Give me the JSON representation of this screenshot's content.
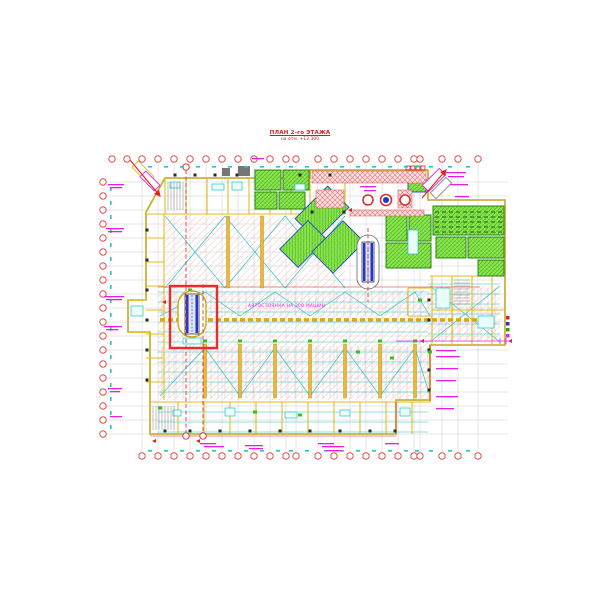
{
  "title": {
    "line1": "ПЛАН 2-го ЭТАЖА",
    "line2": "на отм. +12.300"
  },
  "labels": {
    "parking": "АВТОСТОЯНКА НА 300 МАШИН"
  },
  "colors": {
    "axis_red": "#e05050",
    "red": "#e02020",
    "wall_yellow": "#e2bb22",
    "wall_dark": "#a98a00",
    "strip_yellow": "#efb63a",
    "green_fill": "#8ae24e",
    "green_dark": "#2f9e12",
    "blue": "#2336c8",
    "cyan": "#27c3c3",
    "magenta": "#e81ee8",
    "grid_gray": "#c2c2c2",
    "pink": "#efb3b3",
    "dark": "#2a2a2a"
  },
  "drawing": {
    "grid": {
      "xs": [
        142,
        158,
        174,
        190,
        206,
        222,
        238,
        254,
        270,
        286,
        296,
        318,
        334,
        350,
        366,
        382,
        398,
        414,
        420,
        442,
        458,
        478
      ],
      "top_extra": [
        112,
        127
      ],
      "ys": [
        182,
        196,
        210,
        224,
        238,
        252,
        266,
        280,
        294,
        308,
        322,
        336,
        350,
        364,
        378,
        392,
        406,
        420,
        434
      ],
      "x1": 106,
      "x2": 508,
      "y1": 163,
      "y2": 452,
      "top_y": 159,
      "bottom_y": 456,
      "left_x": 103,
      "tick_top_y": 166,
      "tick_bottom_y": 450,
      "tick_left_x": 110
    },
    "outline": "165,178 310,178 310,170 428,170 428,200 505,200 505,345 430,345 430,400 396,400 396,434 150,434 150,332 128,332 128,300 146,300 146,212",
    "zones": [
      {
        "x": 165,
        "y": 216,
        "w": 180,
        "h": 72
      },
      {
        "x": 158,
        "y": 290,
        "w": 272,
        "h": 110
      },
      {
        "x": 430,
        "y": 286,
        "w": 70,
        "h": 56
      }
    ],
    "stall_bands": [
      {
        "x1": 162,
        "x2": 428,
        "y": 292,
        "h": 24,
        "step": 7
      },
      {
        "x1": 162,
        "x2": 428,
        "y": 346,
        "h": 52,
        "step": 7
      },
      {
        "x1": 432,
        "x2": 498,
        "y": 288,
        "h": 52,
        "step": 7
      }
    ],
    "cyan_bands": [
      {
        "x1": 158,
        "x2": 428,
        "y1": 292,
        "y2": 432,
        "step": 10
      },
      {
        "x1": 428,
        "x2": 500,
        "y1": 284,
        "y2": 342,
        "step": 10
      }
    ],
    "cyan_zigzags": [
      "165,288 225,216 285,288 345,216",
      "165,216 225,288 285,216 345,288",
      "160,316 205,292 240,316 275,292 310,316 345,292 380,316 415,292 430,316",
      "160,396 205,348 240,396 275,348 310,396 345,348 380,396 415,348 430,396",
      "430,342 500,286",
      "430,286 500,342"
    ],
    "walls": [
      [
        146,
        214,
        345,
        214
      ],
      [
        165,
        178,
        165,
        214
      ],
      [
        186,
        178,
        186,
        214
      ],
      [
        207,
        178,
        207,
        214
      ],
      [
        228,
        178,
        228,
        214
      ],
      [
        249,
        178,
        249,
        214
      ],
      [
        270,
        178,
        270,
        214
      ],
      [
        291,
        178,
        291,
        214
      ],
      [
        310,
        178,
        310,
        214
      ],
      [
        345,
        178,
        345,
        214
      ],
      [
        164,
        214,
        164,
        400
      ],
      [
        146,
        238,
        164,
        238
      ],
      [
        146,
        262,
        164,
        262
      ],
      [
        146,
        286,
        164,
        286
      ],
      [
        146,
        310,
        164,
        310
      ],
      [
        146,
        334,
        164,
        334
      ],
      [
        146,
        358,
        164,
        358
      ],
      [
        146,
        382,
        164,
        382
      ],
      [
        150,
        402,
        430,
        402
      ],
      [
        178,
        402,
        178,
        434
      ],
      [
        204,
        402,
        204,
        434
      ],
      [
        230,
        402,
        230,
        434
      ],
      [
        256,
        402,
        256,
        434
      ],
      [
        282,
        402,
        282,
        434
      ],
      [
        308,
        402,
        308,
        434
      ],
      [
        334,
        402,
        334,
        434
      ],
      [
        360,
        402,
        360,
        434
      ],
      [
        386,
        402,
        386,
        434
      ],
      [
        412,
        402,
        412,
        434
      ],
      [
        430,
        276,
        505,
        276
      ],
      [
        432,
        276,
        432,
        344
      ],
      [
        452,
        276,
        452,
        344
      ],
      [
        472,
        276,
        472,
        344
      ],
      [
        492,
        276,
        492,
        344
      ],
      [
        432,
        310,
        505,
        310
      ],
      [
        408,
        288,
        432,
        288
      ],
      [
        408,
        288,
        408,
        316
      ],
      [
        408,
        316,
        432,
        316
      ],
      [
        128,
        300,
        146,
        300
      ],
      [
        128,
        332,
        150,
        332
      ]
    ],
    "red_lines": [
      [
        158,
        287,
        480,
        287
      ],
      [
        430,
        345,
        430,
        402
      ],
      [
        396,
        402,
        396,
        434
      ],
      [
        150,
        436,
        396,
        436
      ]
    ],
    "yellow_strips": {
      "lower": {
        "xs": [
          205,
          240,
          275,
          310,
          345,
          380,
          415
        ],
        "y1": 344,
        "y2": 398
      },
      "upper": {
        "xs": [
          228,
          262
        ],
        "y1": 216,
        "y2": 288
      }
    },
    "dashed_band": {
      "x1": 160,
      "x2": 478,
      "y": 320
    },
    "green_rooms": [
      {
        "x": 255,
        "y": 170,
        "w": 26,
        "h": 20
      },
      {
        "x": 283,
        "y": 170,
        "w": 26,
        "h": 20
      },
      {
        "x": 255,
        "y": 192,
        "w": 22,
        "h": 17
      },
      {
        "x": 279,
        "y": 192,
        "w": 26,
        "h": 17
      },
      {
        "x": 386,
        "y": 215,
        "w": 21,
        "h": 26
      },
      {
        "x": 409,
        "y": 215,
        "w": 22,
        "h": 26
      },
      {
        "x": 386,
        "y": 243,
        "w": 45,
        "h": 25
      },
      {
        "x": 433,
        "y": 206,
        "w": 71,
        "h": 29,
        "desk": true
      },
      {
        "x": 436,
        "y": 237,
        "w": 30,
        "h": 21
      },
      {
        "x": 468,
        "y": 237,
        "w": 36,
        "h": 21
      },
      {
        "x": 478,
        "y": 260,
        "w": 26,
        "h": 16
      },
      {
        "x": 408,
        "y": 178,
        "w": 18,
        "h": 14,
        "blue": true
      }
    ],
    "green_diag": [
      {
        "cx": 322,
        "cy": 213,
        "w": 46,
        "h": 30,
        "r": -45
      },
      {
        "cx": 303,
        "cy": 244,
        "w": 40,
        "h": 26,
        "r": -45
      },
      {
        "cx": 338,
        "cy": 247,
        "w": 44,
        "h": 30,
        "r": -45
      }
    ],
    "red_hatch": [
      {
        "x": 312,
        "y": 171,
        "w": 114,
        "h": 12
      },
      {
        "x": 316,
        "y": 190,
        "w": 28,
        "h": 18
      },
      {
        "x": 398,
        "y": 190,
        "w": 14,
        "h": 18
      },
      {
        "x": 350,
        "y": 210,
        "w": 74,
        "h": 6
      }
    ],
    "red_squares": [
      [
        406,
        166
      ],
      [
        411,
        166
      ],
      [
        416,
        166
      ],
      [
        421,
        166
      ]
    ],
    "circles": {
      "y": 200,
      "items": [
        {
          "x": 368,
          "r": 5
        },
        {
          "x": 386,
          "r": 5.5,
          "blue": true
        },
        {
          "x": 405,
          "r": 5
        }
      ]
    },
    "escalators": [
      {
        "cx": 192,
        "top": 294,
        "w": 14,
        "h": 40,
        "rx": 14,
        "ry": 23,
        "oy": 314,
        "main": true
      },
      {
        "cx": 368,
        "top": 242,
        "w": 12,
        "h": 40,
        "rx": 11,
        "ry": 27,
        "oy": 262
      }
    ],
    "highlight_box": {
      "x": 170,
      "y": 286,
      "w": 47,
      "h": 62
    },
    "red_dashed": [
      {
        "x": 186,
        "y1": 170,
        "y2": 432,
        "b1": 167,
        "b2": 436
      },
      {
        "x": 203,
        "y1": 284,
        "y2": 432,
        "b2": 436
      },
      {
        "x": 368,
        "y1": 228,
        "y2": 302
      }
    ],
    "cyan_rects": [
      [
        170,
        182,
        10,
        6
      ],
      [
        212,
        184,
        12,
        6
      ],
      [
        232,
        182,
        10,
        8
      ],
      [
        295,
        184,
        10,
        6
      ],
      [
        173,
        410,
        8,
        6
      ],
      [
        225,
        408,
        10,
        8
      ],
      [
        285,
        412,
        12,
        6
      ],
      [
        340,
        410,
        10,
        6
      ],
      [
        400,
        408,
        10,
        8
      ],
      [
        436,
        288,
        14,
        20
      ],
      [
        478,
        316,
        16,
        12
      ],
      [
        183,
        338,
        18,
        6
      ],
      [
        408,
        230,
        10,
        24
      ],
      [
        131,
        306,
        12,
        10
      ]
    ],
    "dark_rects": [
      [
        222,
        168,
        8,
        8
      ],
      [
        238,
        166,
        12,
        10
      ]
    ],
    "marks_dark": [
      [
        175,
        175
      ],
      [
        195,
        175
      ],
      [
        215,
        175
      ],
      [
        237,
        175
      ],
      [
        300,
        175
      ],
      [
        330,
        175
      ],
      [
        165,
        431
      ],
      [
        190,
        431
      ],
      [
        220,
        431
      ],
      [
        250,
        431
      ],
      [
        280,
        431
      ],
      [
        310,
        431
      ],
      [
        340,
        431
      ],
      [
        370,
        431
      ],
      [
        395,
        431
      ],
      [
        147,
        230
      ],
      [
        147,
        260
      ],
      [
        147,
        290
      ],
      [
        147,
        320
      ],
      [
        147,
        350
      ],
      [
        147,
        380
      ],
      [
        429,
        300
      ],
      [
        429,
        320
      ],
      [
        429,
        350
      ],
      [
        429,
        370
      ],
      [
        429,
        390
      ],
      [
        344,
        212
      ],
      [
        312,
        212
      ]
    ],
    "marks_green": [
      [
        160,
        408
      ],
      [
        358,
        352
      ],
      [
        392,
        358
      ],
      [
        300,
        415
      ],
      [
        255,
        412
      ],
      [
        420,
        300
      ],
      [
        430,
        352
      ],
      [
        190,
        290
      ],
      [
        205,
        341
      ],
      [
        240,
        341
      ],
      [
        275,
        341
      ],
      [
        310,
        341
      ],
      [
        345,
        341
      ],
      [
        380,
        341
      ],
      [
        415,
        341
      ]
    ],
    "marks_red": [
      [
        196,
        441
      ],
      [
        152,
        441
      ],
      [
        162,
        302
      ],
      [
        348,
        210
      ],
      [
        420,
        341
      ],
      [
        508,
        341
      ]
    ],
    "magenta_bars": [
      [
        108,
        184,
        16
      ],
      [
        110,
        187,
        12
      ],
      [
        106,
        228,
        18
      ],
      [
        108,
        231,
        14
      ],
      [
        104,
        296,
        20
      ],
      [
        106,
        299,
        16
      ],
      [
        104,
        326,
        18
      ],
      [
        106,
        329,
        12
      ],
      [
        108,
        388,
        14
      ],
      [
        110,
        391,
        10
      ],
      [
        110,
        416,
        12
      ],
      [
        200,
        443,
        16
      ],
      [
        204,
        446,
        20
      ],
      [
        245,
        445,
        18
      ],
      [
        249,
        448,
        14
      ],
      [
        318,
        443,
        16
      ],
      [
        322,
        446,
        22
      ],
      [
        326,
        450,
        16
      ],
      [
        385,
        443,
        14
      ],
      [
        436,
        350,
        20
      ],
      [
        436,
        356,
        24
      ],
      [
        436,
        368,
        22
      ],
      [
        436,
        380,
        20
      ],
      [
        436,
        396,
        22
      ],
      [
        436,
        408,
        18
      ],
      [
        446,
        172,
        20
      ],
      [
        448,
        176,
        16
      ],
      [
        450,
        184,
        18
      ],
      [
        455,
        196,
        14
      ],
      [
        252,
        158,
        12
      ],
      [
        360,
        186,
        16
      ],
      [
        364,
        190,
        12
      ]
    ],
    "magenta_lines": [
      [
        396,
        341,
        512,
        341
      ],
      [
        500,
        338,
        500,
        344
      ],
      [
        506,
        338,
        506,
        344
      ]
    ],
    "colored_squares": [
      {
        "x": 506,
        "y": 316,
        "c": "#e02020"
      },
      {
        "x": 506,
        "y": 322,
        "c": "#2336c8"
      },
      {
        "x": 506,
        "y": 328,
        "c": "#2f9e12"
      },
      {
        "x": 506,
        "y": 334,
        "c": "#e81ee8"
      }
    ],
    "ramps": [
      {
        "cx": 143,
        "cy": 172,
        "w": 22,
        "h": 9,
        "r": 45,
        "c": "wall"
      },
      {
        "cx": 150,
        "cy": 181,
        "w": 20,
        "h": 8,
        "r": 45,
        "c": "magenta"
      },
      {
        "cx": 434,
        "cy": 180,
        "w": 24,
        "h": 9,
        "r": -45,
        "c": "magenta"
      },
      {
        "cx": 441,
        "cy": 188,
        "w": 22,
        "h": 8,
        "r": -45,
        "c": "gray"
      }
    ],
    "arrows": [
      [
        130,
        160,
        160,
        196
      ],
      [
        422,
        198,
        446,
        170
      ]
    ],
    "stairs": [
      {
        "x1": 153,
        "x2": 176,
        "y1": 406,
        "y2": 430,
        "step": 3,
        "vert": true
      },
      {
        "x1": 168,
        "x2": 184,
        "y1": 182,
        "y2": 210,
        "step": 3,
        "vert": true
      },
      {
        "x1": 454,
        "x2": 470,
        "y1": 280,
        "y2": 306,
        "step": 3,
        "vert": false
      }
    ]
  }
}
